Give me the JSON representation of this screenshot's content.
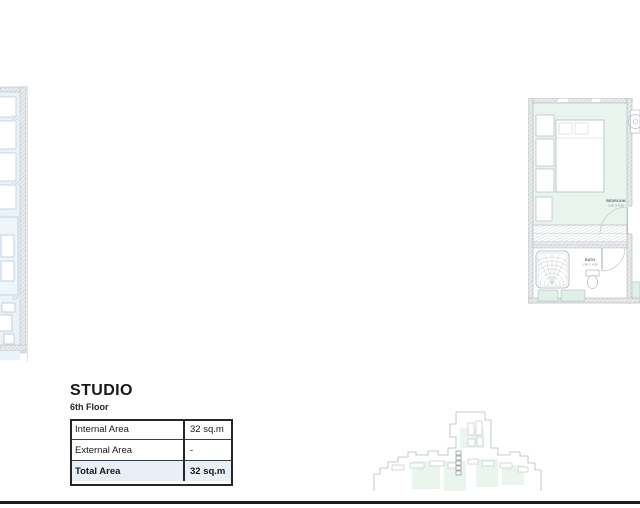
{
  "document": {
    "unit_title": "STUDIO",
    "unit_floor": "6th Floor"
  },
  "area_table": {
    "rows": [
      {
        "label": "Internal Area",
        "value": "32 sq.m"
      },
      {
        "label": "External Area",
        "value": "-"
      },
      {
        "label": "Total Area",
        "value": "32 sq.m"
      }
    ]
  },
  "floor_plan": {
    "bedroom": {
      "name": "BEDROOM",
      "dimensions": "3.90 X 4.50"
    },
    "bath": {
      "name": "BATH",
      "dimensions": "1.90 X 4.50"
    }
  },
  "colors": {
    "room_fill_mint": "#e9f4ee",
    "cabinet_fill_mint": "#dff0e6",
    "adjacent_fill_blue": "#ebf3fa",
    "table_total_row": "#e9eff7",
    "footer_rule": "#1a1b1e",
    "plan_line": "#b6bec4"
  }
}
